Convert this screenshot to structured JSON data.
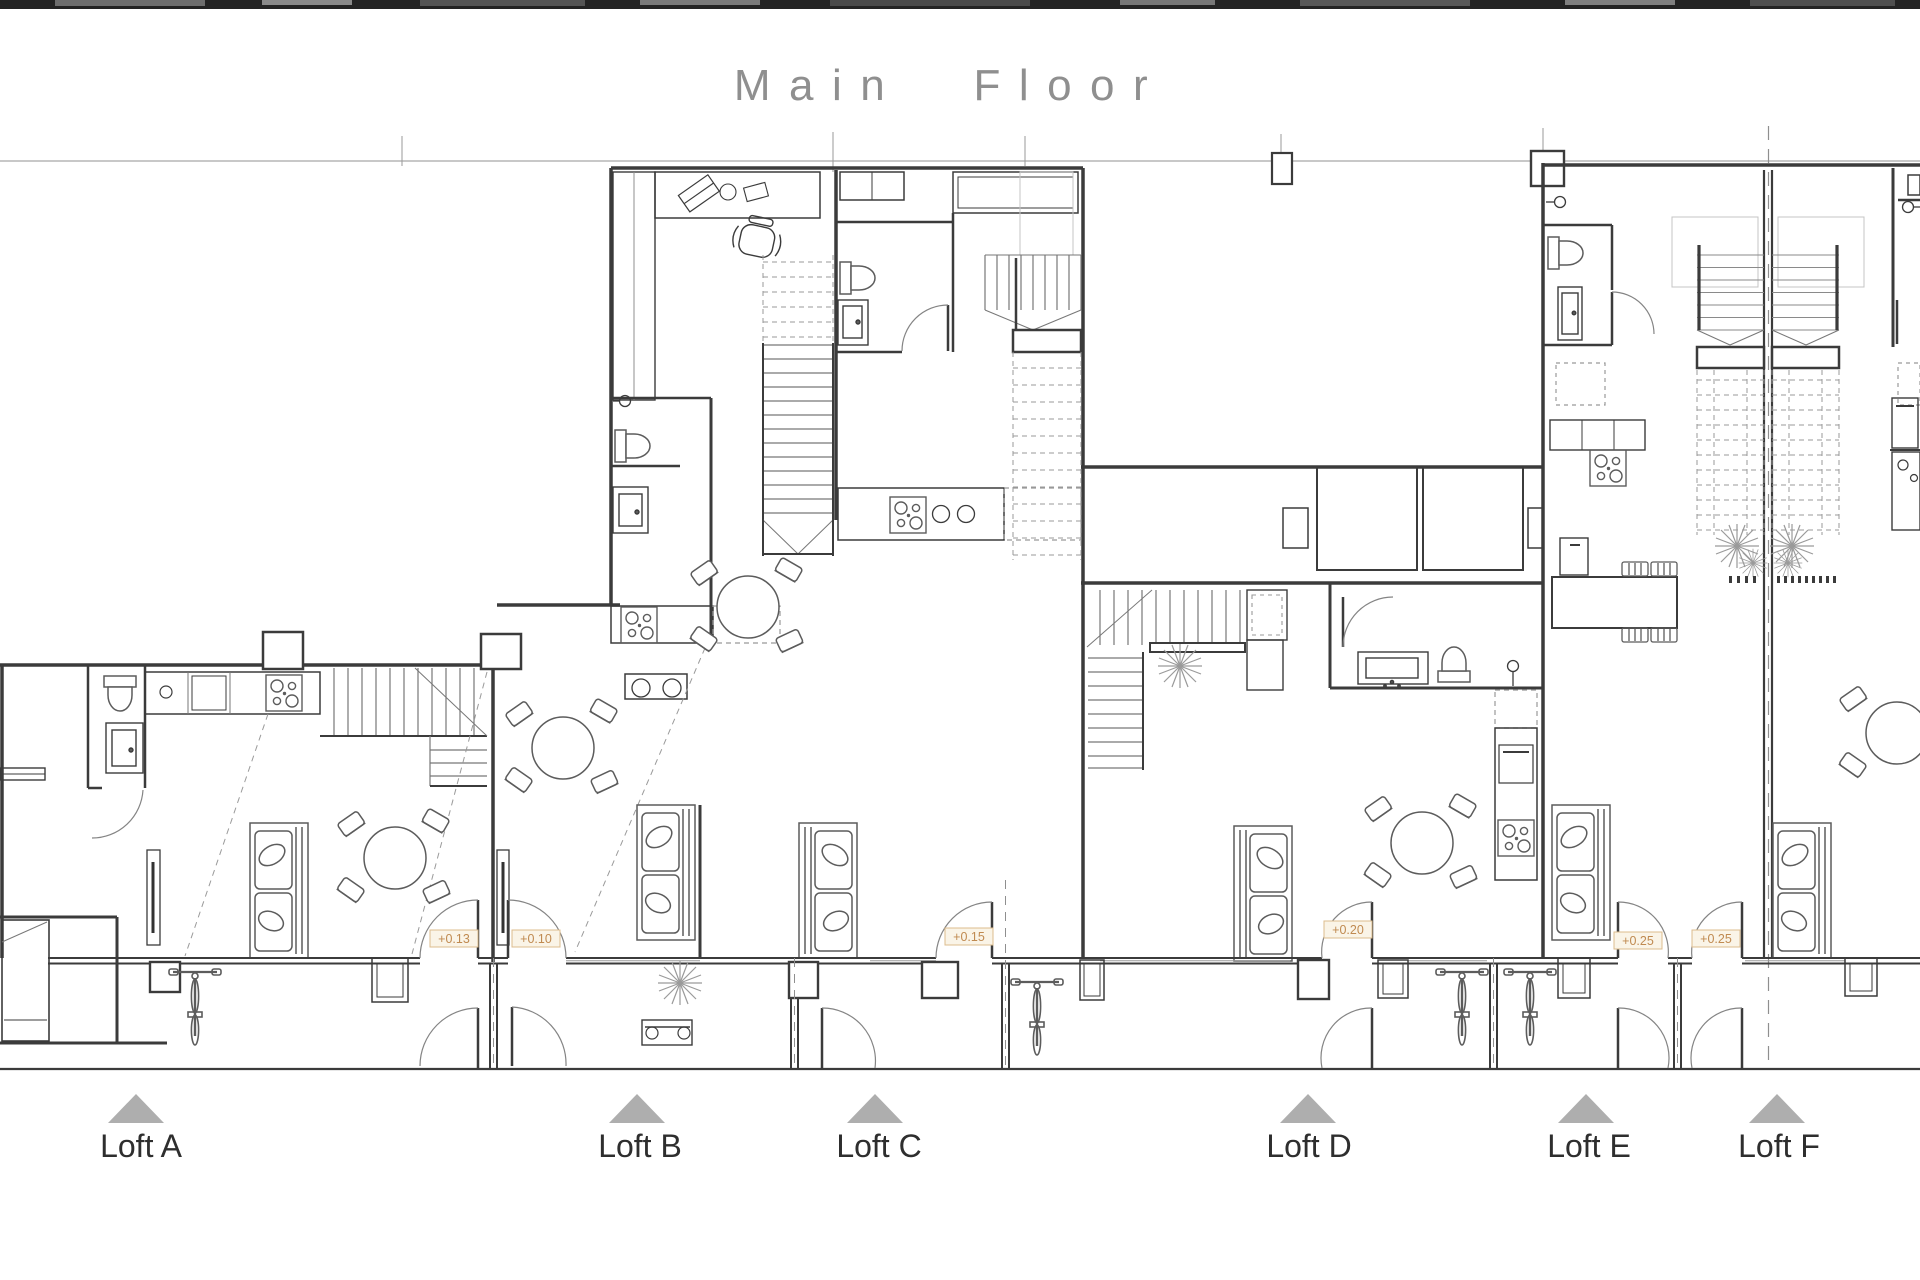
{
  "page": {
    "title": "Main Floor"
  },
  "lofts": [
    {
      "label": "Loft A"
    },
    {
      "label": "Loft B"
    },
    {
      "label": "Loft C"
    },
    {
      "label": "Loft D"
    },
    {
      "label": "Loft E"
    },
    {
      "label": "Loft F"
    }
  ],
  "elevation_markers": [
    {
      "value": "+0.13"
    },
    {
      "value": "+0.10"
    },
    {
      "value": "+0.15"
    },
    {
      "value": "+0.20"
    },
    {
      "value": "+0.25"
    },
    {
      "value": "+0.25"
    }
  ],
  "colors": {
    "wall": "#3b3b3b",
    "furniture": "#5c5c5c",
    "light_line": "#999999",
    "title": "#8f8f8f",
    "label": "#2e2e2e",
    "triangle": "#aeaeae",
    "elevation_text": "#c08a50",
    "elevation_border": "#dcbc8e",
    "elevation_bg": "#faf4e7"
  }
}
